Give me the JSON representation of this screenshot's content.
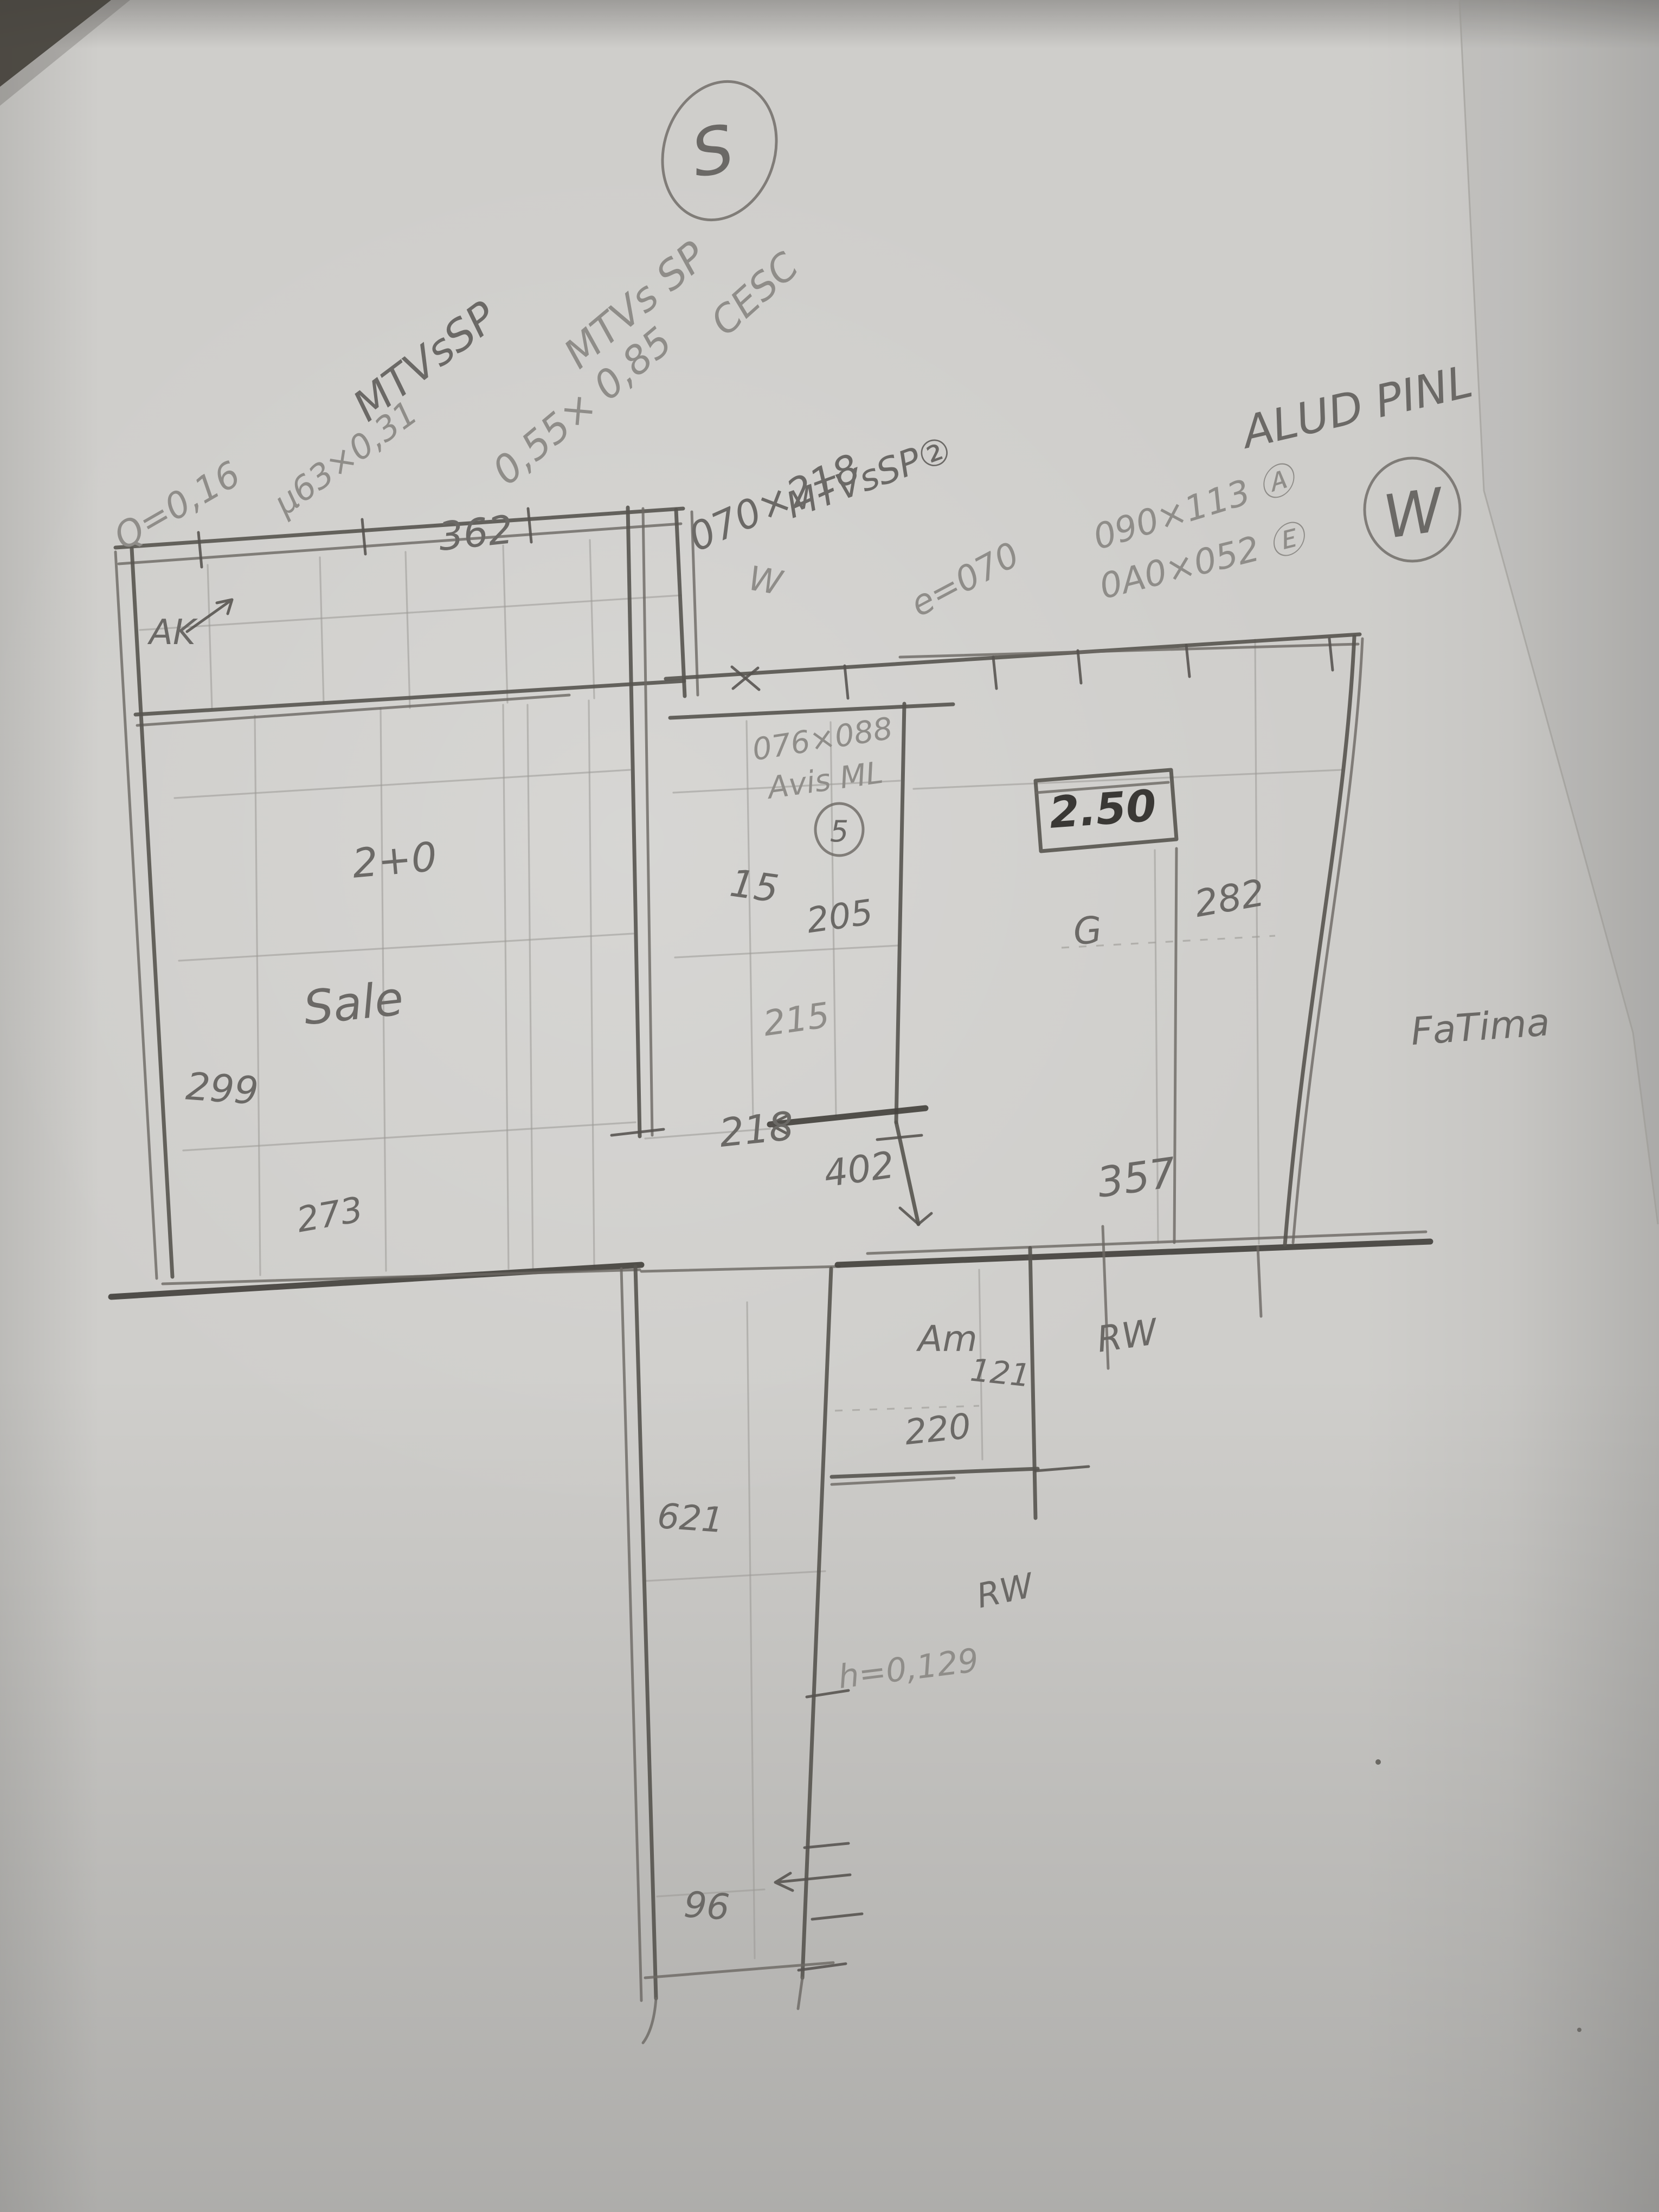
{
  "meta": {
    "description": "Photograph of a hand-drawn pencil floor-plan sketch on gray paper with dimensions and window/door notes",
    "drawing_type": "floor-plan-sketch"
  },
  "palette": {
    "paper": "#cfcecb",
    "pencil": "#6b6966",
    "pencil_dark": "#3a3835",
    "pencil_faint": "#9b9995"
  },
  "labels": [
    {
      "id": "s_compass",
      "text": "S"
    },
    {
      "id": "w_compass",
      "text": "W"
    },
    {
      "id": "mtv_sp_1",
      "text": "MTVsSP"
    },
    {
      "id": "q_016",
      "text": "Q=0,16"
    },
    {
      "id": "dim_163",
      "text": "µ63×0,31"
    },
    {
      "id": "mtv_sp_2",
      "text": "MTVs SP"
    },
    {
      "id": "dim_055",
      "text": "0,55× 0,85"
    },
    {
      "id": "cesc",
      "text": "CESC"
    },
    {
      "id": "dim_070_218",
      "text": "070×218"
    },
    {
      "id": "mtv_sp_2b",
      "text": "MTVsSP②"
    },
    {
      "id": "e_070",
      "text": "e=070"
    },
    {
      "id": "alud_pinl",
      "text": "ALUD PINL"
    },
    {
      "id": "dim_090_113",
      "text": "090×113 Ⓐ"
    },
    {
      "id": "dim_0a0_052",
      "text": "0A0×052 Ⓔ"
    },
    {
      "id": "d362",
      "text": "362"
    },
    {
      "id": "ak",
      "text": "AK"
    },
    {
      "id": "w_door",
      "text": "W"
    },
    {
      "id": "dim_076_088",
      "text": "076×088"
    },
    {
      "id": "avis_ml",
      "text": "Avis ML"
    },
    {
      "id": "circ5",
      "text": "5"
    },
    {
      "id": "boxed_250",
      "text": "2.50"
    },
    {
      "id": "d2_0",
      "text": "2+0"
    },
    {
      "id": "sale",
      "text": "Sale"
    },
    {
      "id": "d15",
      "text": "15"
    },
    {
      "id": "d205",
      "text": "205"
    },
    {
      "id": "d282",
      "text": "282"
    },
    {
      "id": "g_mark",
      "text": "G"
    },
    {
      "id": "d215",
      "text": "215"
    },
    {
      "id": "d218",
      "text": "218"
    },
    {
      "id": "d402",
      "text": "402"
    },
    {
      "id": "d357",
      "text": "357"
    },
    {
      "id": "fatima",
      "text": "FaTima"
    },
    {
      "id": "d299",
      "text": "299"
    },
    {
      "id": "d273",
      "text": "273"
    },
    {
      "id": "am",
      "text": "Am"
    },
    {
      "id": "d121",
      "text": "121"
    },
    {
      "id": "d220",
      "text": "220"
    },
    {
      "id": "rw_upper",
      "text": "RW"
    },
    {
      "id": "d621",
      "text": "621"
    },
    {
      "id": "rw_lower",
      "text": "RW"
    },
    {
      "id": "h_0129",
      "text": "h=0,129"
    },
    {
      "id": "d96",
      "text": "96"
    }
  ]
}
